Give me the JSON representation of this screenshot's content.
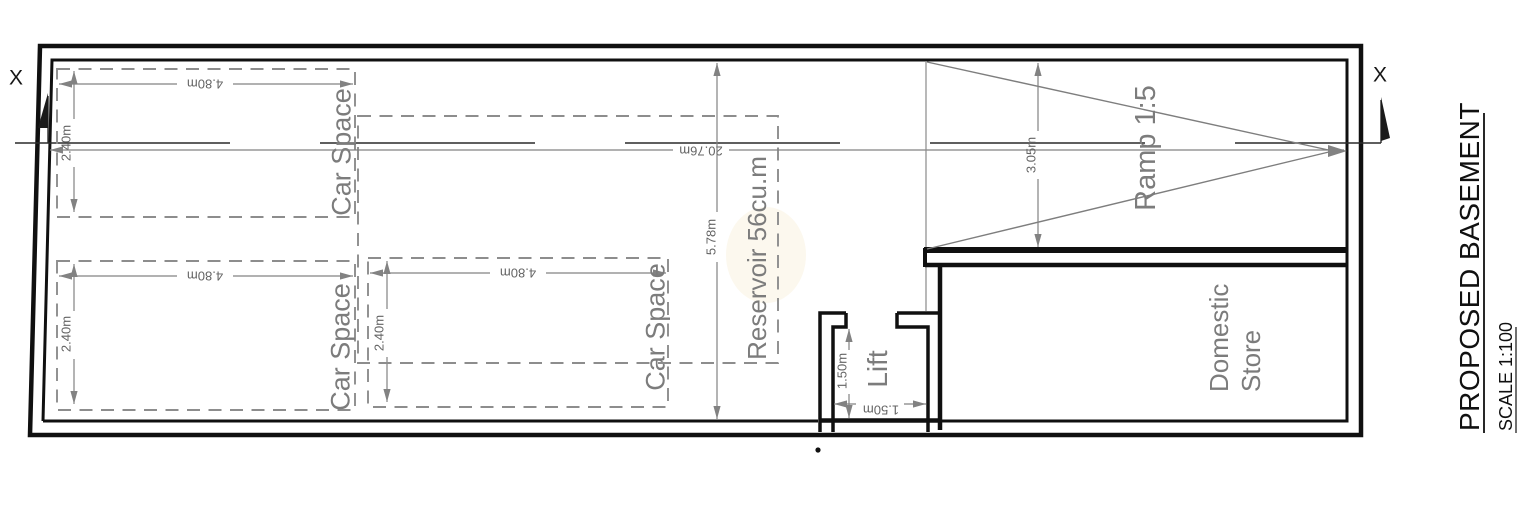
{
  "drawing": {
    "title": "PROPOSED BASEMENT",
    "scale_note": "SCALE 1:100",
    "section_marker": "X",
    "rooms": {
      "car_space": "Car Space",
      "reservoir": "Reservoir 56cu.m",
      "ramp": "Ramp 1:5",
      "lift": "Lift",
      "domestic_store_line1": "Domestic",
      "domestic_store_line2": "Store"
    },
    "dimensions": {
      "car_length": "4.80m",
      "car_width": "2.40m",
      "interior_length": "20.76m",
      "interior_depth": "5.78m",
      "ramp_width": "3.05m",
      "lift_width": "1.50m",
      "lift_depth": "1.50m"
    },
    "colors": {
      "wall_black": "#101010",
      "annotation_gray": "#848484",
      "room_text_gray": "#7c7c7c",
      "dim_text_gray": "#646464"
    }
  }
}
